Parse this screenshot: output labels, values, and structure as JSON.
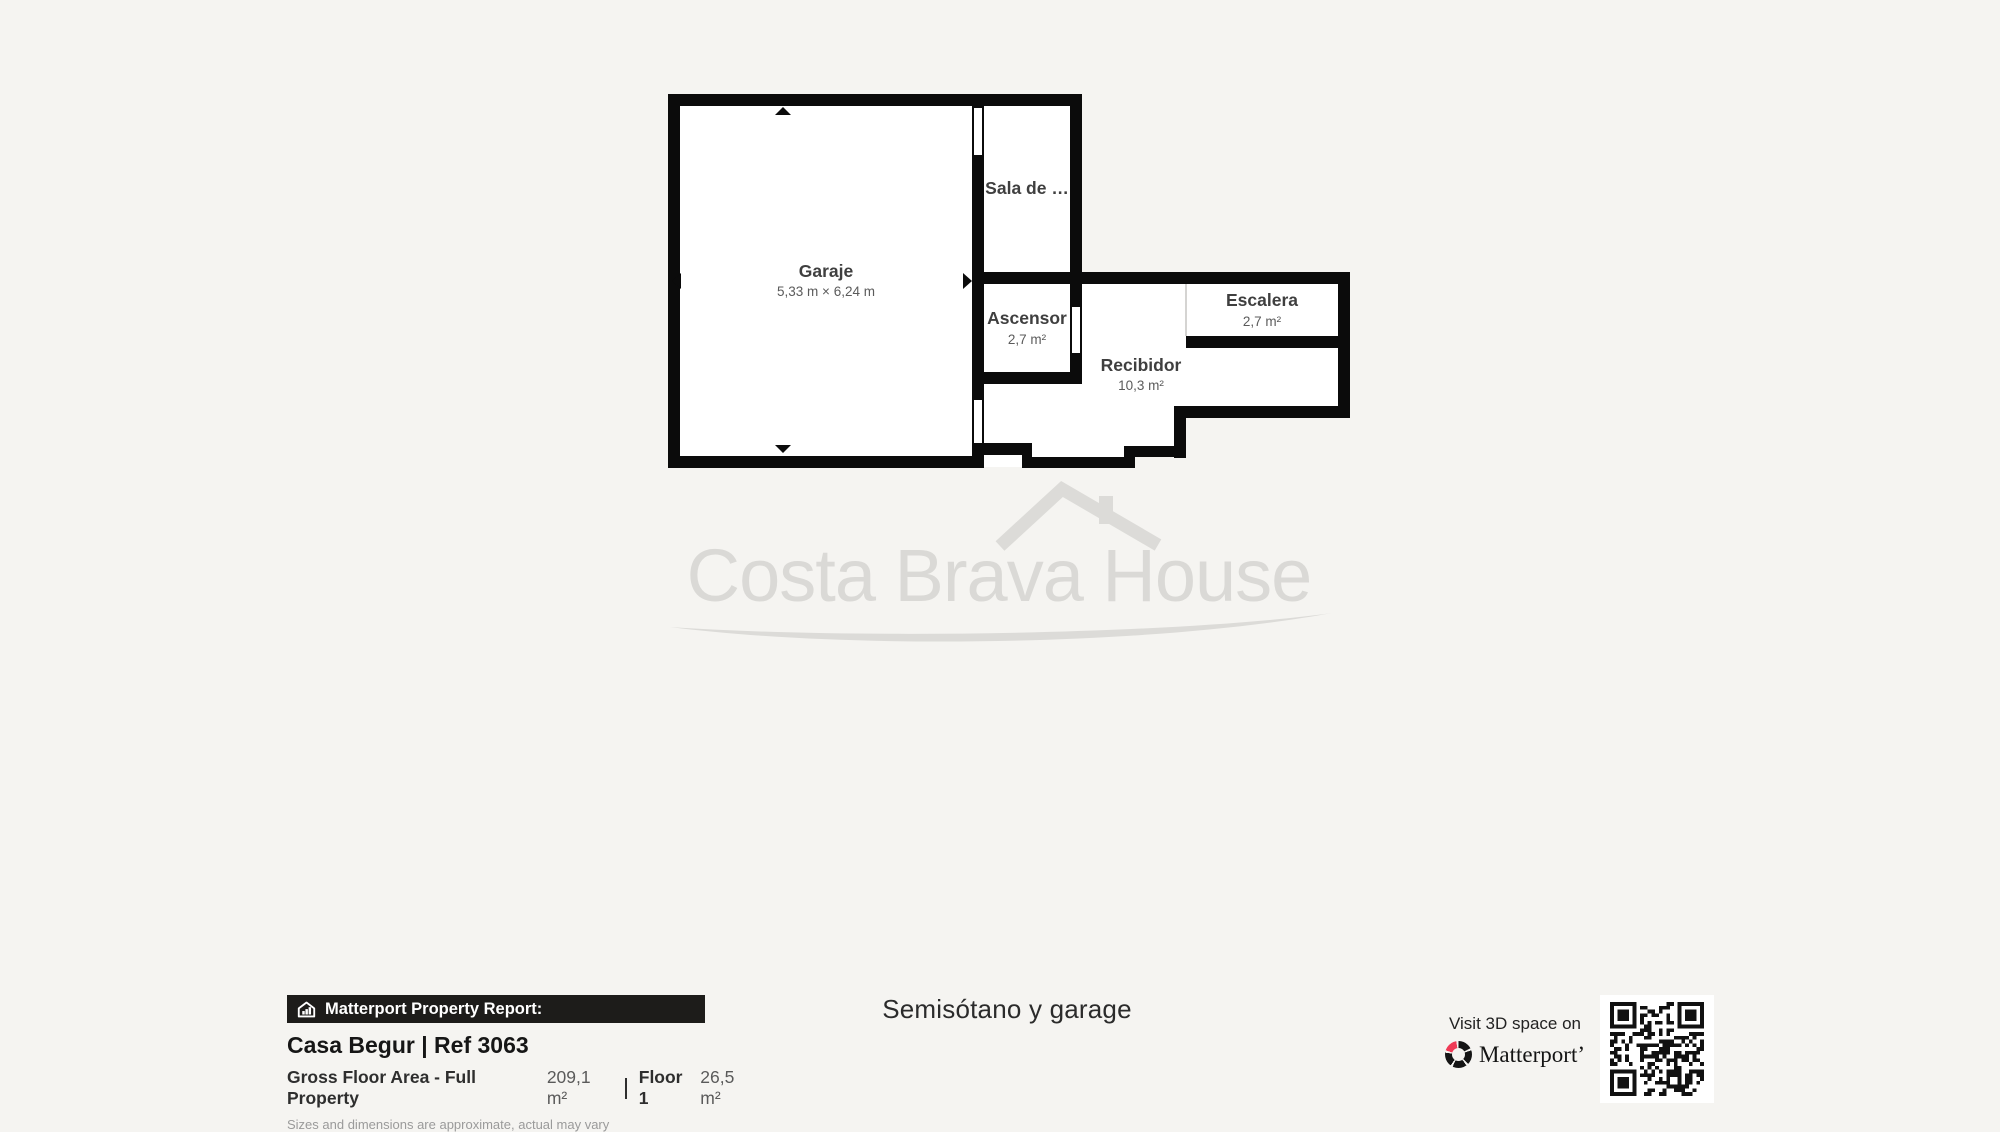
{
  "floorplan": {
    "rooms": [
      {
        "id": "garaje",
        "name": "Garaje",
        "dims": "5,33 m × 6,24 m"
      },
      {
        "id": "sala",
        "name": "Sala de …",
        "dims": ""
      },
      {
        "id": "ascensor",
        "name": "Ascensor",
        "dims": "2,7 m²"
      },
      {
        "id": "escalera",
        "name": "Escalera",
        "dims": "2,7 m²"
      },
      {
        "id": "recibidor",
        "name": "Recibidor",
        "dims": "10,3 m²"
      }
    ]
  },
  "watermark": {
    "text": "Costa Brava House"
  },
  "report": {
    "bar_label": "Matterport Property Report:",
    "property_title": "Casa Begur | Ref 3063",
    "gross_label": "Gross Floor Area - Full Property",
    "gross_value": "209,1 m²",
    "floor_label": "Floor 1",
    "floor_value": "26,5 m²",
    "disclaimer": "Sizes and dimensions are approximate, actual may vary"
  },
  "floor_title": "Semisótano y garage",
  "cta": {
    "visit_text": "Visit 3D space on",
    "brand": "Matterport’"
  },
  "colors": {
    "background": "#f5f4f1",
    "wall": "#0b0b0b",
    "room_fill": "#ffffff",
    "watermark": "#dad9d6",
    "bar_bg": "#1d1c1a",
    "matterport_pink": "#ef3a56"
  }
}
